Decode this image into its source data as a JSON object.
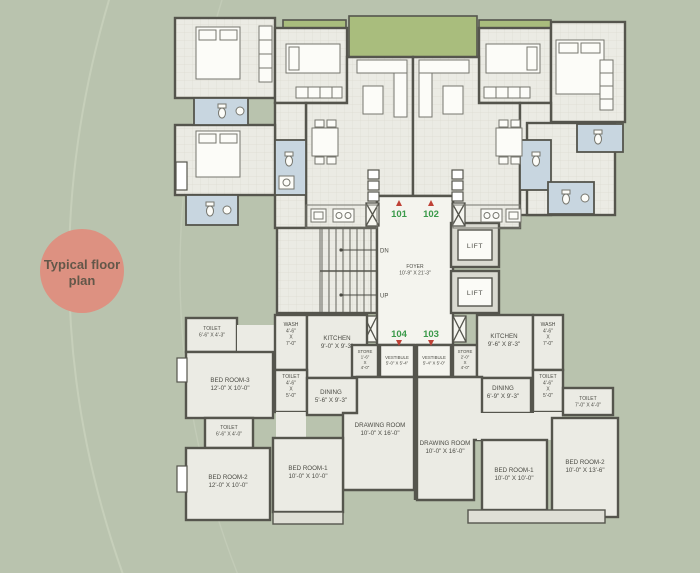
{
  "colors": {
    "background": "#b9c3ae",
    "badge": "#dd9181",
    "wall": "#55554d",
    "floor": "#ebebe4",
    "planter": "#a9bd7d",
    "bath": "#c8d6e0",
    "unit_number_green": "#3a9a4a",
    "door_marker_red": "#bf4136",
    "label_text": "#4b4b44"
  },
  "badge": {
    "lines": [
      "Typical floor",
      "plan"
    ]
  },
  "core": {
    "foyer": {
      "lines": [
        "FOYER",
        "10'-9\" X 21'-3\""
      ]
    },
    "lift_top": "LIFT",
    "lift_bottom": "LIFT",
    "down": "DN",
    "up": "UP"
  },
  "unit_numbers": {
    "top_left": "101",
    "top_right": "102",
    "bottom_left": "104",
    "bottom_right": "103"
  },
  "rooms": [
    {
      "id": "toilet-upper-left",
      "lines": [
        "TOILET",
        "6'-6\" X 4'-3\""
      ]
    },
    {
      "id": "bed-room-3",
      "lines": [
        "BED ROOM-3",
        "12'-0\" X 10'-0\""
      ]
    },
    {
      "id": "wash-left",
      "lines": [
        "WASH",
        "4'-6\"",
        "X",
        "7'-0\""
      ]
    },
    {
      "id": "kitchen-left",
      "lines": [
        "KITCHEN",
        "9'-0\" X 9'-3\""
      ]
    },
    {
      "id": "store-left",
      "lines": [
        "STORE",
        "1'-6\"",
        "X",
        "4'-0\""
      ]
    },
    {
      "id": "vestibule-left",
      "lines": [
        "VESTIBULE",
        "5'-0\" X 5'-4\""
      ]
    },
    {
      "id": "vestibule-right",
      "lines": [
        "VESTIBULE",
        "5'-4\" X 5'-0\""
      ]
    },
    {
      "id": "store-right",
      "lines": [
        "STORE",
        "2'-0\"",
        "X",
        "4'-0\""
      ]
    },
    {
      "id": "kitchen-right",
      "lines": [
        "KITCHEN",
        "9'-6\" X 8'-3\""
      ]
    },
    {
      "id": "wash-right",
      "lines": [
        "WASH",
        "4'-6\"",
        "X",
        "7'-0\""
      ]
    },
    {
      "id": "toilet-left-small",
      "lines": [
        "TOILET",
        "4'-6\"",
        "X",
        "5'-0\""
      ]
    },
    {
      "id": "dining-left",
      "lines": [
        "DINING",
        "5'-6\" X 9'-3\""
      ]
    },
    {
      "id": "dining-right",
      "lines": [
        "DINING",
        "6'-9\" X 9'-3\""
      ]
    },
    {
      "id": "toilet-right-small",
      "lines": [
        "TOILET",
        "4'-6\"",
        "X",
        "5'-0\""
      ]
    },
    {
      "id": "toilet-far-right",
      "lines": [
        "TOILET",
        "7'-0\" X 4'-0\""
      ]
    },
    {
      "id": "toilet-lower-left",
      "lines": [
        "TOILET",
        "6'-6\" X 4'-0\""
      ]
    },
    {
      "id": "bed-room-2-left",
      "lines": [
        "BED ROOM-2",
        "12'-0\" X 10'-0\""
      ]
    },
    {
      "id": "bed-room-1-left",
      "lines": [
        "BED ROOM-1",
        "10'-0\" X 10'-0\""
      ]
    },
    {
      "id": "drawing-room-left",
      "lines": [
        "DRAWING ROOM",
        "10'-0\" X 16'-0\""
      ]
    },
    {
      "id": "drawing-room-right",
      "lines": [
        "DRAWING ROOM",
        "10'-0\" X 16'-0\""
      ]
    },
    {
      "id": "bed-room-1-right",
      "lines": [
        "BED ROOM-1",
        "10'-0\" X 10'-0\""
      ]
    },
    {
      "id": "bed-room-2-right",
      "lines": [
        "BED ROOM-2",
        "10'-0\" X 13'-6\""
      ]
    }
  ]
}
